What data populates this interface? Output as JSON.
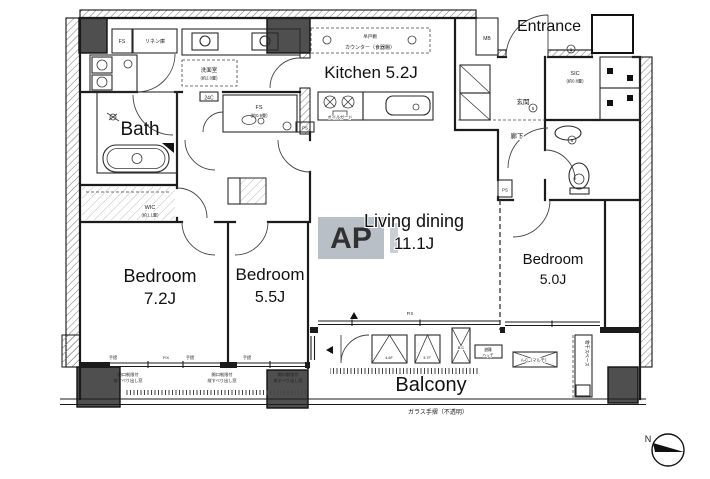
{
  "rooms": {
    "entrance": {
      "label": "Entrance"
    },
    "kitchen": {
      "label": "Kitchen 5.2J"
    },
    "bath": {
      "label": "Bath"
    },
    "living": {
      "label": "Living dining",
      "size": "11.1J"
    },
    "bedroom1": {
      "label": "Bedroom",
      "size": "7.2J"
    },
    "bedroom2": {
      "label": "Bedroom",
      "size": "5.5J"
    },
    "bedroom3": {
      "label": "Bedroom",
      "size": "5.0J"
    },
    "balcony": {
      "label": "Balcony"
    }
  },
  "jp": {
    "genkan": "玄関",
    "hallway": "廊下",
    "washroom": "洗面室",
    "washroom_size": "(約2.0畳)",
    "linen": "リネン庫",
    "wic": "WIC",
    "wic_size": "(約1.1畳)",
    "sic": "SIC",
    "sic_size": "(約0.8畳)",
    "fs": "FS",
    "fs_size": "(約0.9畳)",
    "mb": "MB",
    "ps": "PS",
    "vent_24c": "24C",
    "hanging_cupboard": "吊戸棚",
    "counter_cupboard": "カウンター（食器棚）",
    "oil_guard": "オイルガード",
    "fix": "FIX",
    "handrail": "手摺",
    "window_note_1": "開口制限付",
    "window_note_2": "縦すべり出し窓",
    "escape_hatch_1": "避難",
    "escape_hatch_2": "ハッチ",
    "ac_multi": "A-C（マルチ）",
    "ac_space_1": "4.6F",
    "ac_space_2": "3.7F",
    "ac_space_3": "B-C",
    "laundry_space": "物干スペース",
    "glass_rail": "ガラス手摺（不透明）",
    "north": "N"
  },
  "markers": {
    "note_1": "1",
    "note_5": "5"
  },
  "watermark": {
    "letters": "AP"
  },
  "colors": {
    "line": "#1b1b1b",
    "column": "#4f4f4f",
    "watermark": "#b2b9c1"
  }
}
